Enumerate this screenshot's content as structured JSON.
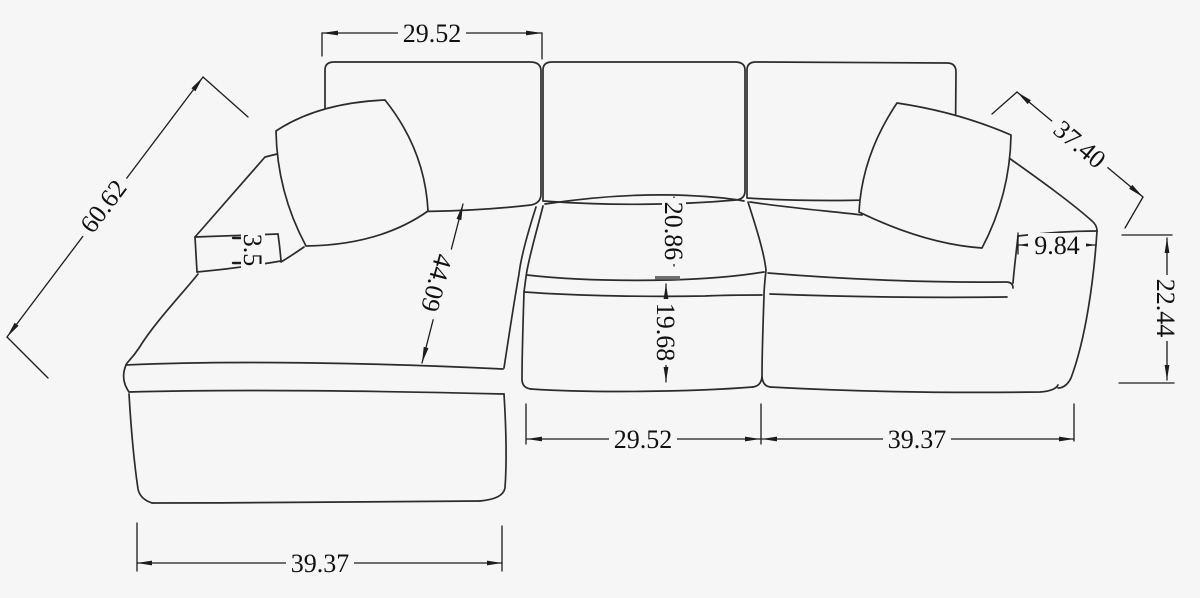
{
  "page": {
    "background": "#f6f6f6",
    "ink": "#2b2b2b",
    "dimension_ink": "#1c1c1c"
  },
  "figure": {
    "kind": "technical line drawing",
    "subject": "sectional sofa with left chaise, three back cushions, two throw pillows, right arm"
  },
  "dims": {
    "back_width_top": "29.52",
    "chaise_diagonal_left": "60.62",
    "arm_front_thickness": "3.5",
    "chaise_seat_diagonal": "44.09",
    "seat_depth": "20.86",
    "base_height": "19.68",
    "arm_width": "9.84",
    "arm_diagonal_right": "37.40",
    "side_height": "22.44",
    "middle_seat_width_bottom": "29.52",
    "right_seat_width_bottom": "39.37",
    "chaise_width_bottom": "39.37"
  }
}
